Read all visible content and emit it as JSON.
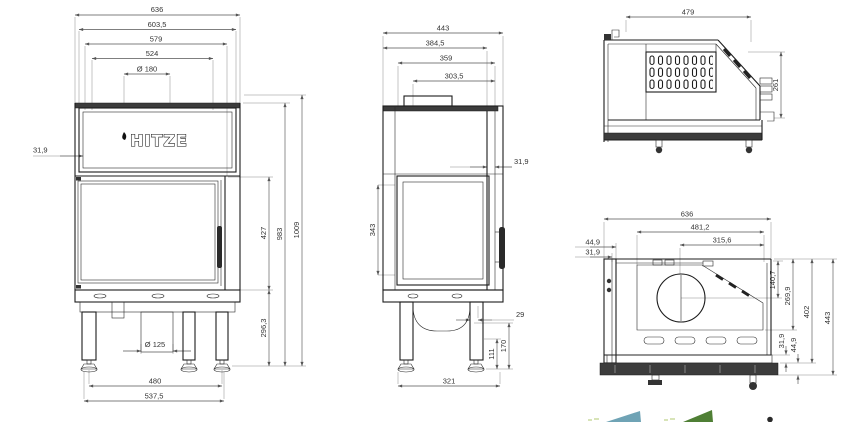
{
  "brand": {
    "logo_text": "HITZE"
  },
  "front_view": {
    "total_width": "636",
    "top_width": "603,5",
    "frame_width": "579",
    "glass_width": "524",
    "flue_diameter": "Ø 180",
    "panel_inset": "31,9",
    "glass_height": "427",
    "body_height": "983",
    "total_height": "1009",
    "base_height": "296,3",
    "intake_diameter": "Ø 125",
    "feet_spacing": "480",
    "base_width": "537,5"
  },
  "side_view": {
    "total_depth": "443",
    "top_depth": "384,5",
    "frame_depth": "359",
    "glass_depth": "303,5",
    "frame_inset": "31,9",
    "glass_height": "343",
    "leg_offset": "29",
    "foot_height": "111",
    "base_clearance": "170",
    "feet_spacing": "321"
  },
  "section_view": {
    "top_width": "479",
    "outlet_height": "261"
  },
  "plan_view": {
    "total_width": "636",
    "inner_width": "481,2",
    "flue_offset": "315,6",
    "rear_inset_outer": "44,9",
    "rear_inset_inner": "31,9",
    "flue_depth": "140,7",
    "chamber_depth": "269,9",
    "body_depth": "402",
    "total_depth": "443",
    "front_inset_inner": "31,9",
    "front_inset_outer": "44,9"
  },
  "footer_graphics": {
    "teal_shape_color": "#6fa3b5",
    "green_shape_color": "#4f7f35",
    "pale_dash_color": "#d8e4b8",
    "dot_color": "#2a2a2a"
  }
}
